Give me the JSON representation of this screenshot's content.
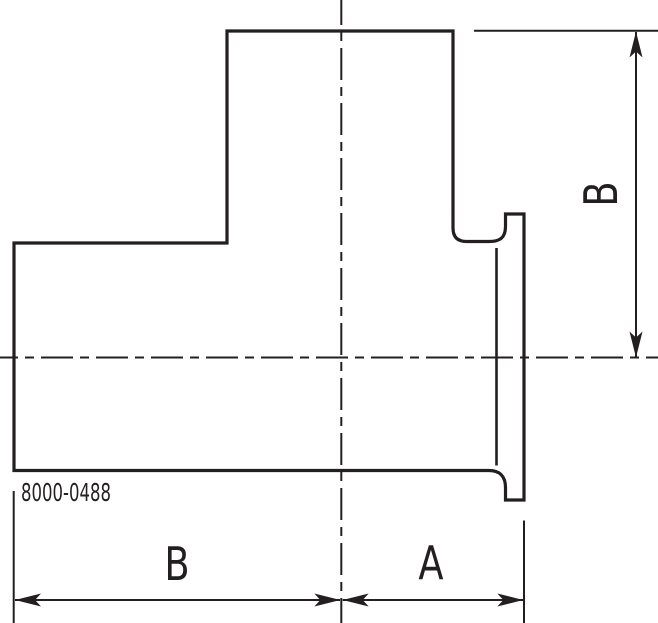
{
  "drawing": {
    "part_number": "8000-0488",
    "dimensions": {
      "branch_height": {
        "label": "B"
      },
      "run_length": {
        "label": "B"
      },
      "ferrule_length": {
        "label": "A"
      }
    },
    "colors": {
      "line": "#231f20",
      "background": "#ffffff"
    }
  }
}
